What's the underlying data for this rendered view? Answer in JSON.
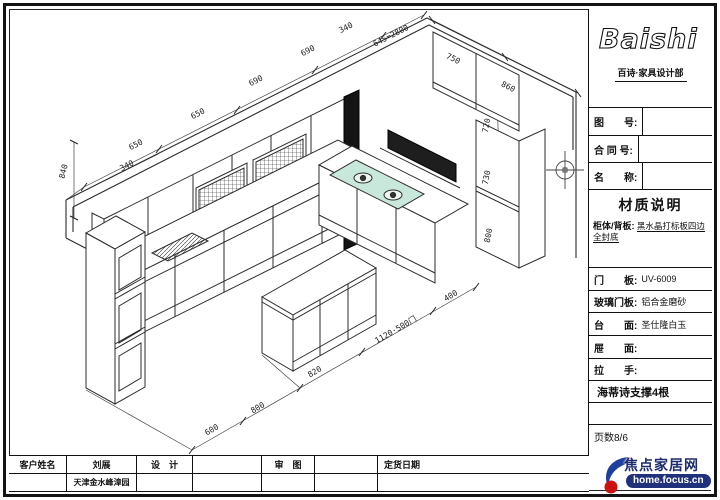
{
  "title_block": {
    "logo_text": "Baishi",
    "subtitle": "百诗·家具设计部",
    "fields": [
      {
        "label": "图　　号:",
        "value": ""
      },
      {
        "label": "合 同 号:",
        "value": ""
      },
      {
        "label": "名　　称:",
        "value": ""
      }
    ],
    "material_title": "材质说明",
    "materials": [
      {
        "label": "柜体/背板:",
        "value": "黑水晶打标板四边全封底"
      },
      {
        "label": "门　　板:",
        "value": "UV-6009"
      },
      {
        "label": "玻璃门板:",
        "value": "铝合金磨砂"
      },
      {
        "label": "台　　面:",
        "value": "圣仕隆白玉"
      },
      {
        "label": "屉　　面:",
        "value": ""
      },
      {
        "label": "拉　　手:",
        "value": ""
      }
    ],
    "hardware_note": "海蒂诗支撑4根",
    "page_label": "页数8/6"
  },
  "bottom_table": {
    "customer_label": "客户姓名",
    "customer_name": "刘展",
    "design_label": "设　计",
    "design_value": "",
    "review_label": "审　图",
    "review_value": "",
    "order_date_label": "定货日期",
    "address": "天津金水峰漳园"
  },
  "watermark": {
    "site_name": "焦点家居网",
    "site_url": "home.focus.cn"
  },
  "colors": {
    "line": "#2b2b2b",
    "hood": "#1e1e1e",
    "pillar": "#141414",
    "hob_glass": "#c9e8dc",
    "watermark_navy": "#21307a",
    "watermark_red": "#cc1111"
  },
  "drawing": {
    "dimension_labels": [
      {
        "text": "650",
        "x": 137,
        "y": 147,
        "rot": -27
      },
      {
        "text": "650",
        "x": 199,
        "y": 116,
        "rot": -27
      },
      {
        "text": "690",
        "x": 257,
        "y": 83,
        "rot": -27
      },
      {
        "text": "690",
        "x": 309,
        "y": 53,
        "rot": -27
      },
      {
        "text": "340",
        "x": 347,
        "y": 30,
        "rot": -27
      },
      {
        "text": "645=2800",
        "x": 392,
        "y": 38,
        "rot": -27
      },
      {
        "text": "340",
        "x": 128,
        "y": 168,
        "rot": -27
      },
      {
        "text": "840",
        "x": 66,
        "y": 172,
        "rot": -76
      },
      {
        "text": "750",
        "x": 452,
        "y": 61,
        "rot": 27
      },
      {
        "text": "860",
        "x": 507,
        "y": 89,
        "rot": 27
      },
      {
        "text": "720",
        "x": 489,
        "y": 126,
        "rot": -78
      },
      {
        "text": "730",
        "x": 489,
        "y": 178,
        "rot": -78
      },
      {
        "text": "800",
        "x": 491,
        "y": 236,
        "rot": -78
      },
      {
        "text": "600",
        "x": 213,
        "y": 432,
        "rot": -30
      },
      {
        "text": "800",
        "x": 259,
        "y": 410,
        "rot": -30
      },
      {
        "text": "820",
        "x": 316,
        "y": 374,
        "rot": -30
      },
      {
        "text": "1120·500门",
        "x": 397,
        "y": 332,
        "rot": -30
      },
      {
        "text": "400",
        "x": 452,
        "y": 298,
        "rot": -30
      }
    ]
  }
}
